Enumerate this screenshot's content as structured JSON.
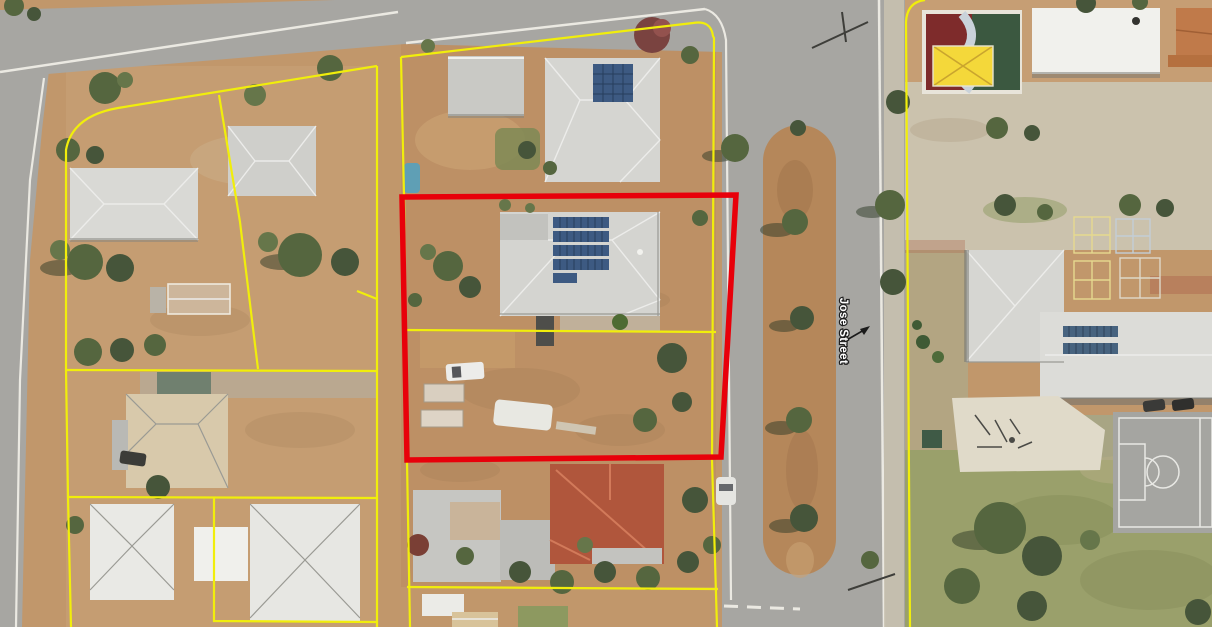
{
  "map": {
    "street_label": "Jose Street",
    "highlight": {
      "color": "#e8000a"
    },
    "boundary_color": "#f1ee0b",
    "palette": {
      "road": "#a7a6a2",
      "dirt": "#c1976b",
      "median_dirt": "#b5875a",
      "grass": "#9aa06b",
      "roof_light_gray": "#d5d5d1",
      "roof_terracotta": "#b0563c",
      "solar_panel_blue": "#3d5a82",
      "shade_canopy_yellow": "#f4d83a",
      "tree_green": "#55663f",
      "kerb_white": "#ebe9e2"
    }
  }
}
